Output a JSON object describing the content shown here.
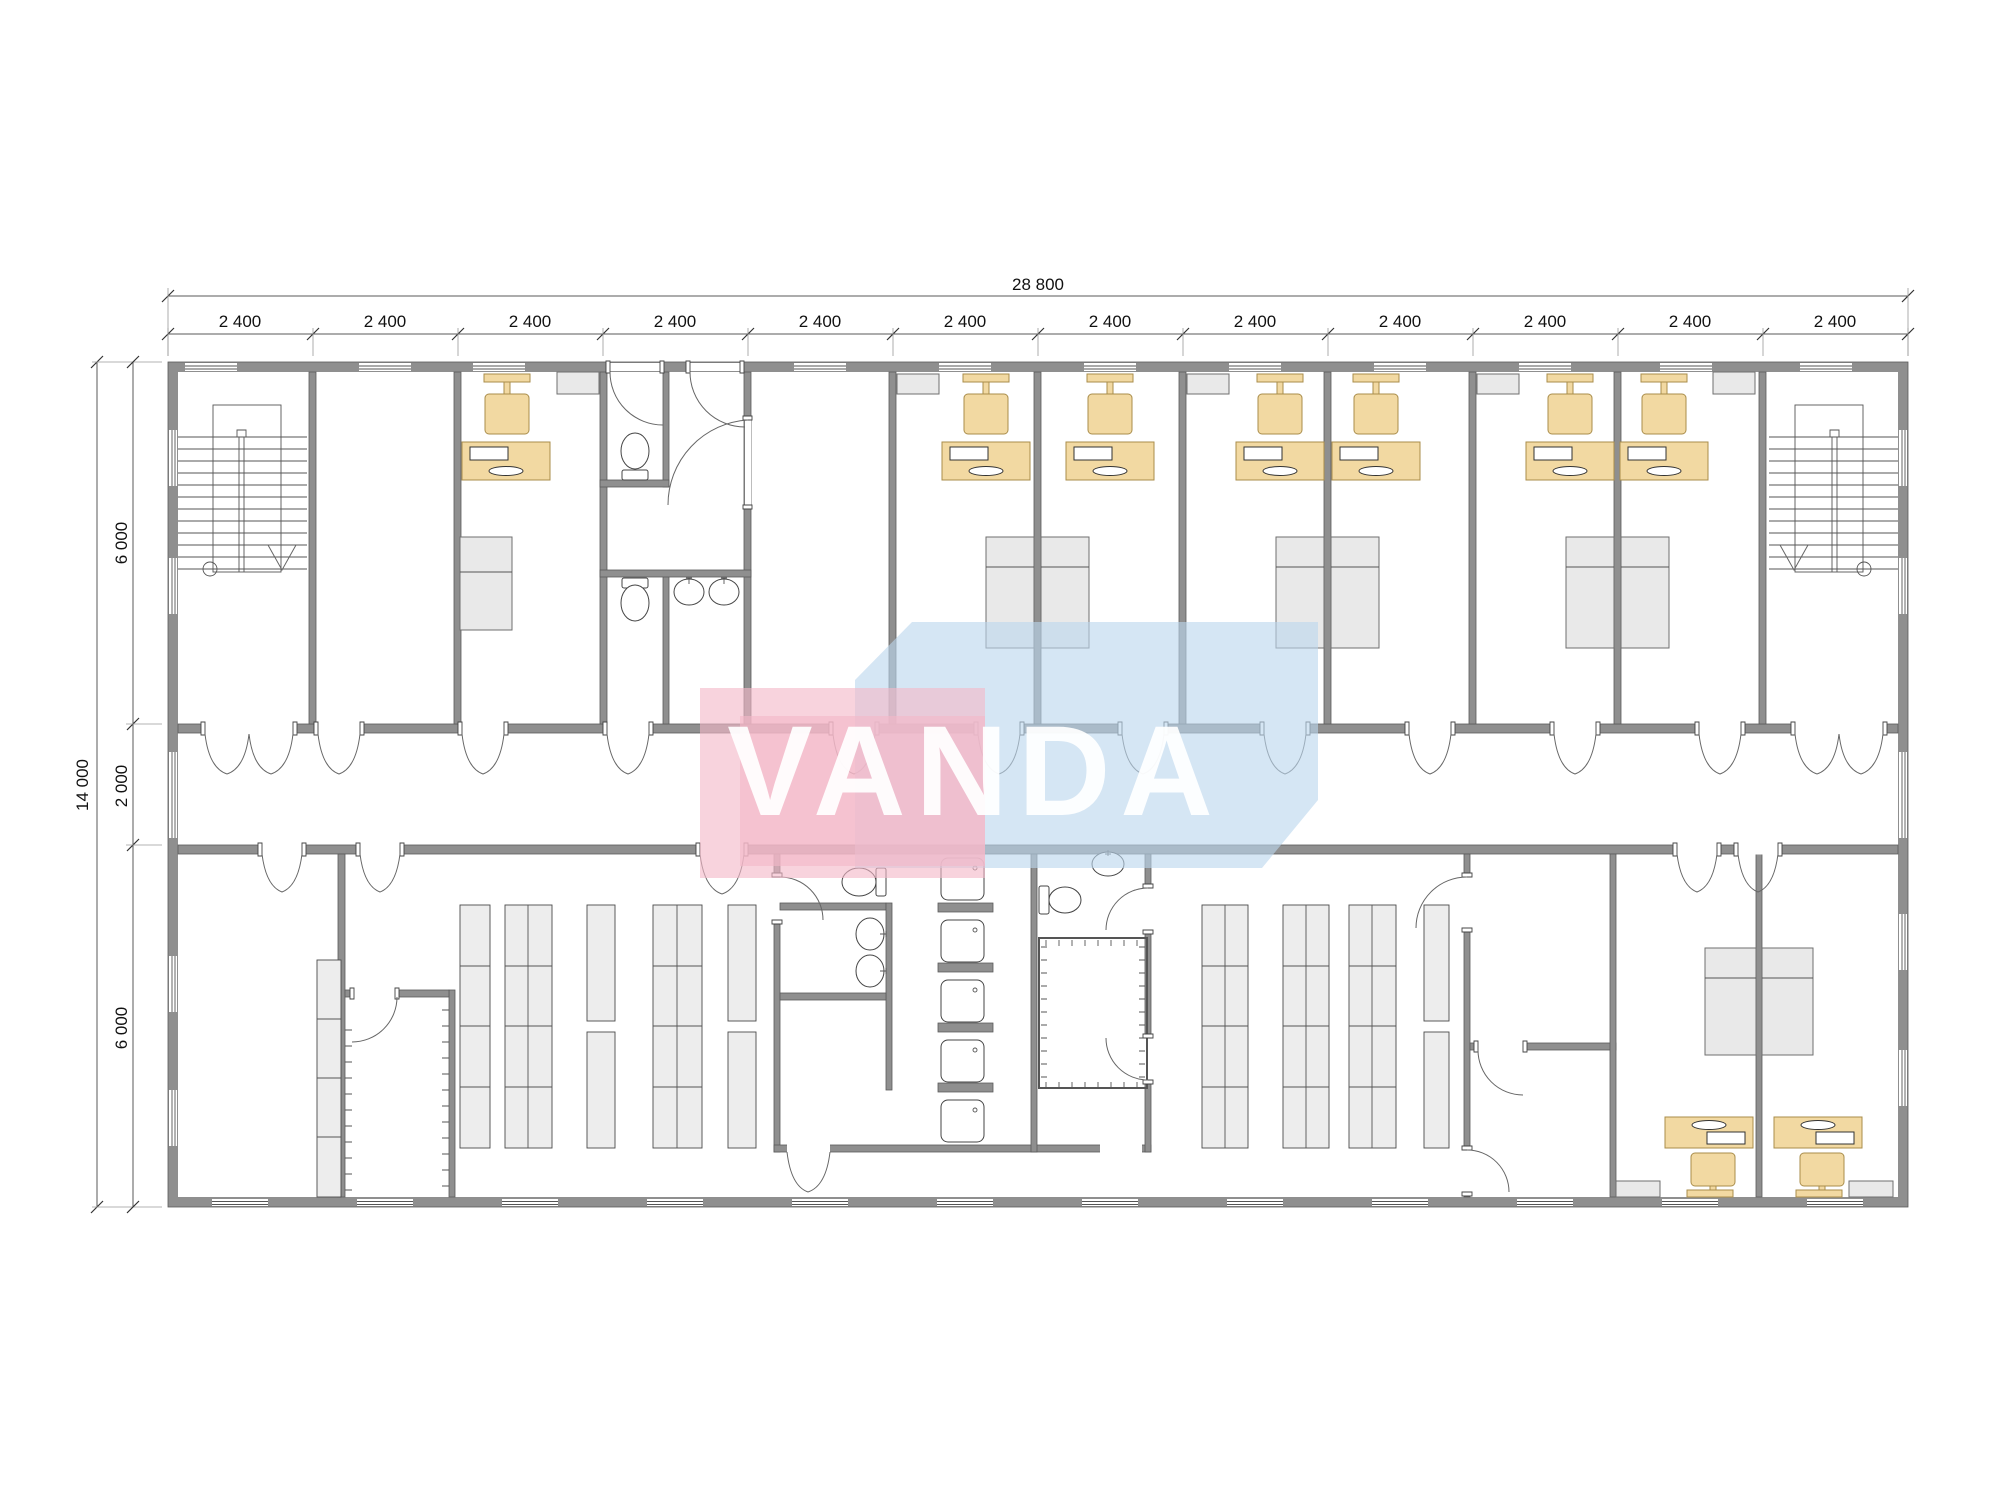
{
  "watermark": {
    "text": "VANDA",
    "pink": "#f4b8c8",
    "blue": "#bcd7ee"
  },
  "dimensions": {
    "top_total": "28 800",
    "top_segments": [
      "2 400",
      "2 400",
      "2 400",
      "2 400",
      "2 400",
      "2 400",
      "2 400",
      "2 400",
      "2 400",
      "2 400",
      "2 400",
      "2 400"
    ],
    "left_total": "14 000",
    "left_segments": [
      "6 000",
      "2 000",
      "6 000"
    ]
  },
  "colors": {
    "wall": "#8f8f8f",
    "furniture_accent": "#f2d9a2",
    "furniture_gray": "#e9e9e9",
    "watermark_pink": "#f4b8c8",
    "watermark_blue": "#bcd7ee",
    "dimension_text": "#111111"
  },
  "icons": {
    "toilet": "toilet-icon",
    "sink": "sink-icon",
    "shower": "shower-tray-icon",
    "stairs": "staircase",
    "desk": "desk",
    "chair": "chair",
    "monitor": "monitor",
    "wardrobe": "wardrobe",
    "rack": "shelving-rack"
  }
}
